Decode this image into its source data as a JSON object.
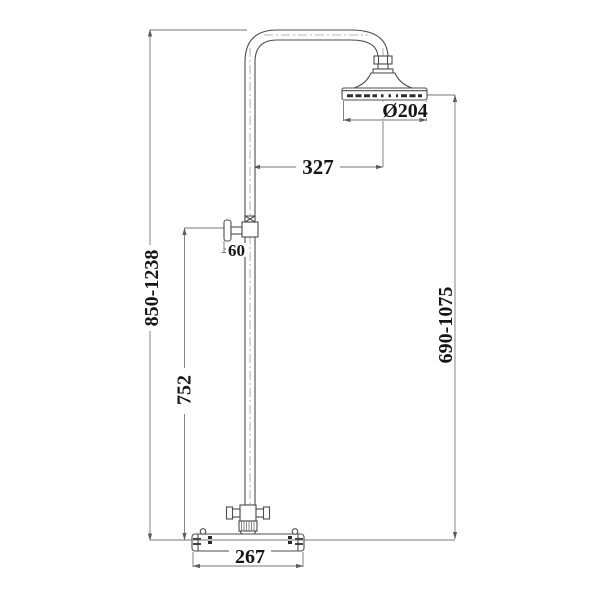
{
  "drawing": {
    "type": "technical-drawing",
    "subject": "thermostatic shower column with rigid riser, wall bracket, round rain head and exposed bar valve",
    "colors": {
      "background": "#ffffff",
      "outline": "#4d4d4d",
      "dimension_line": "#767676",
      "centerline": "#9d9d9d",
      "text": "#161616"
    },
    "dimensions": {
      "overall_height": "850-1238",
      "riser_to_valve": "752",
      "bracket_offset": "60",
      "arm_reach": "327",
      "head_diameter": "Ø204",
      "head_to_valve": "690-1075",
      "valve_width": "267"
    }
  }
}
